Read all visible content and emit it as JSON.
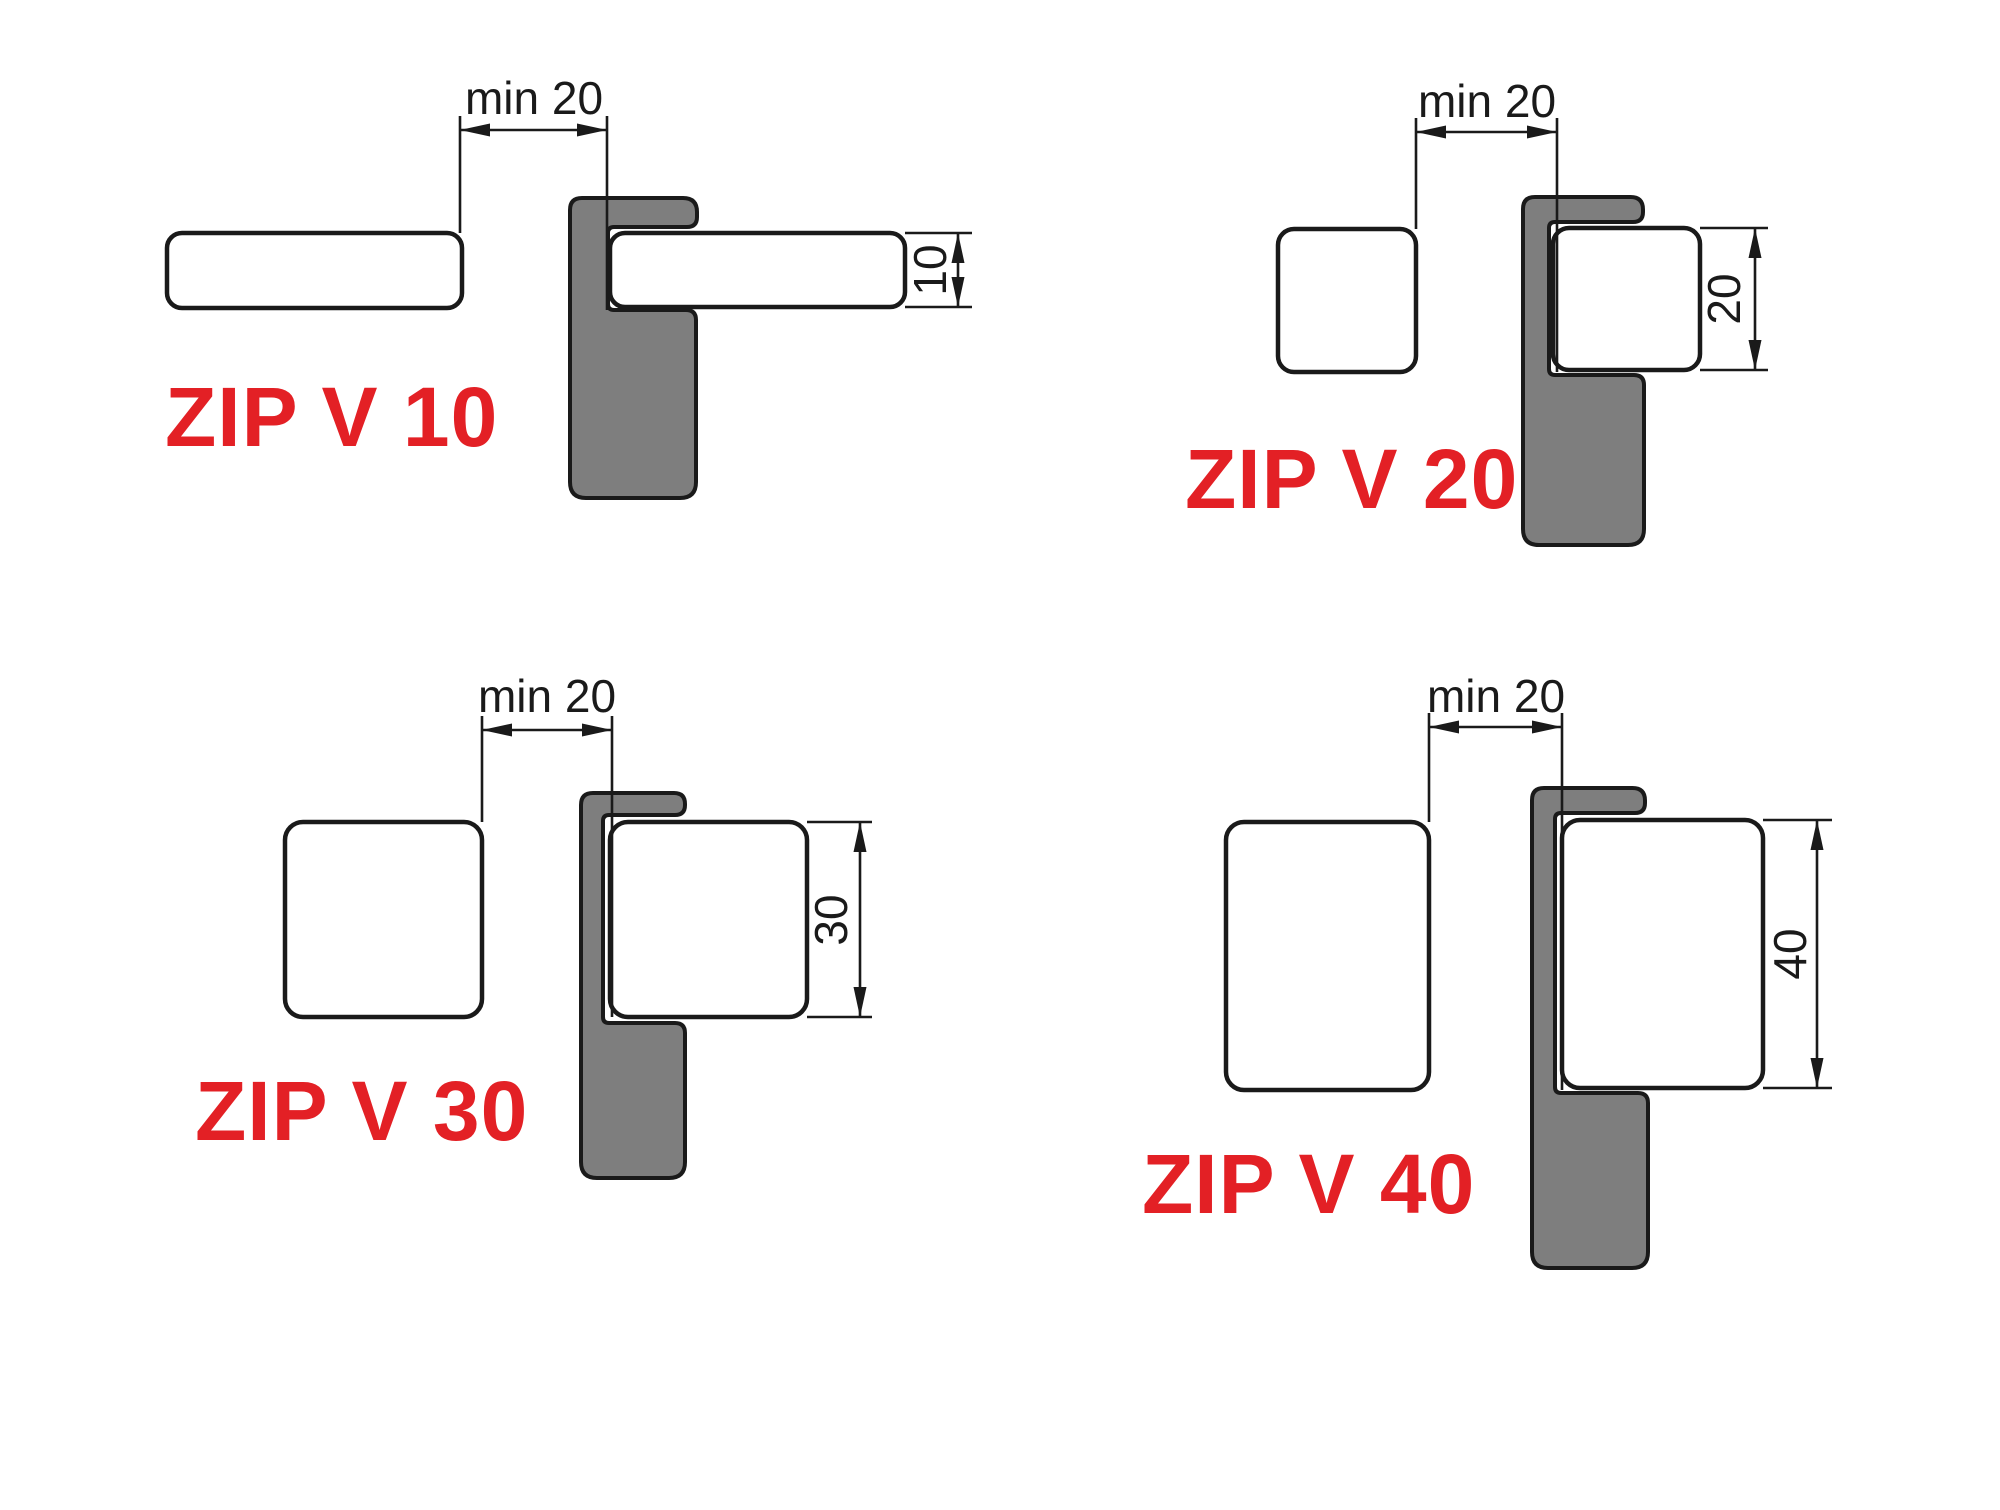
{
  "page": {
    "title": "ZIP V clip profile mounting diagrams",
    "background": "#ffffff"
  },
  "colors": {
    "profile_gray": "#7e7e7e",
    "panel_white": "#ffffff",
    "outline_black": "#1a1a1a",
    "label_red": "#e32025"
  },
  "diagrams": [
    {
      "name": "ZIP V 10",
      "gap_label": "min 20",
      "gap_mm_min": 20,
      "height_label": "10",
      "height_mm": 10
    },
    {
      "name": "ZIP V 20",
      "gap_label": "min 20",
      "gap_mm_min": 20,
      "height_label": "20",
      "height_mm": 20
    },
    {
      "name": "ZIP V 30",
      "gap_label": "min 20",
      "gap_mm_min": 20,
      "height_label": "30",
      "height_mm": 30
    },
    {
      "name": "ZIP V 40",
      "gap_label": "min 20",
      "gap_mm_min": 20,
      "height_label": "40",
      "height_mm": 40
    }
  ]
}
